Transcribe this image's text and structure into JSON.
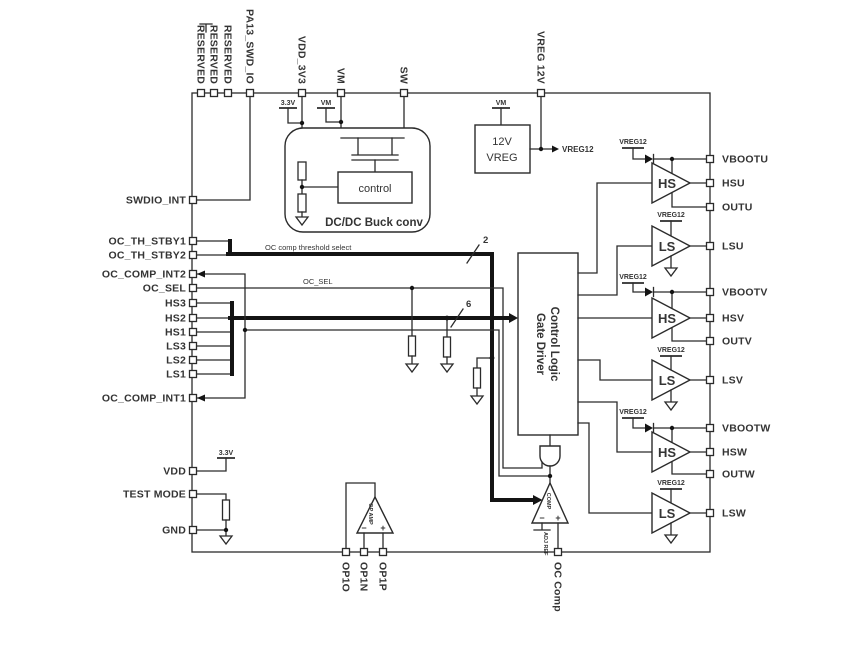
{
  "pins": {
    "top": [
      {
        "label": "RESERVED"
      },
      {
        "label": "RESERVED"
      },
      {
        "label": "RESERVED"
      },
      {
        "label": "PA13_SWD_IO"
      },
      {
        "label": "VDD_3V3"
      },
      {
        "label": "VM"
      },
      {
        "label": "SW"
      },
      {
        "label": "VREG 12V"
      }
    ],
    "left": [
      {
        "label": "SWDIO_INT"
      },
      {
        "label": "OC_TH_STBY1"
      },
      {
        "label": "OC_TH_STBY2"
      },
      {
        "label": "OC_COMP_INT2"
      },
      {
        "label": "OC_SEL"
      },
      {
        "label": "HS3"
      },
      {
        "label": "HS2"
      },
      {
        "label": "HS1"
      },
      {
        "label": "LS3"
      },
      {
        "label": "LS2"
      },
      {
        "label": "LS1"
      },
      {
        "label": "OC_COMP_INT1"
      },
      {
        "label": "VDD"
      },
      {
        "label": "TEST MODE"
      },
      {
        "label": "GND"
      }
    ],
    "right": [
      {
        "label": "VBOOTU"
      },
      {
        "label": "HSU"
      },
      {
        "label": "OUTU"
      },
      {
        "label": "LSU"
      },
      {
        "label": "VBOOTV"
      },
      {
        "label": "HSV"
      },
      {
        "label": "OUTV"
      },
      {
        "label": "LSV"
      },
      {
        "label": "VBOOTW"
      },
      {
        "label": "HSW"
      },
      {
        "label": "OUTW"
      },
      {
        "label": "LSW"
      }
    ],
    "bottom": [
      {
        "label": "OP1O"
      },
      {
        "label": "OP1N"
      },
      {
        "label": "OP1P"
      },
      {
        "label": "OC Comp"
      }
    ]
  },
  "blocks": {
    "buck": {
      "title": "DC/DC Buck conv",
      "control": "control"
    },
    "vreg": {
      "line1": "12V",
      "line2": "VREG"
    },
    "logic": {
      "line1": "Control Logic",
      "line2": "Gate Driver"
    },
    "comparator": {
      "label": "COMP",
      "ref": "ADJ REF",
      "minus": "−",
      "plus": "+"
    },
    "opamp": {
      "label": "OP AMP",
      "minus": "−",
      "plus": "+"
    }
  },
  "nets": {
    "vreg12": "VREG12",
    "v33": "3.3V",
    "vm": "VM",
    "th_select": "OC comp threshold select",
    "oc_sel": "OC_SEL",
    "bus2": "2",
    "bus6": "6"
  },
  "drivers": [
    {
      "label": "HS"
    },
    {
      "label": "LS"
    },
    {
      "label": "HS"
    },
    {
      "label": "LS"
    },
    {
      "label": "HS"
    },
    {
      "label": "LS"
    }
  ]
}
